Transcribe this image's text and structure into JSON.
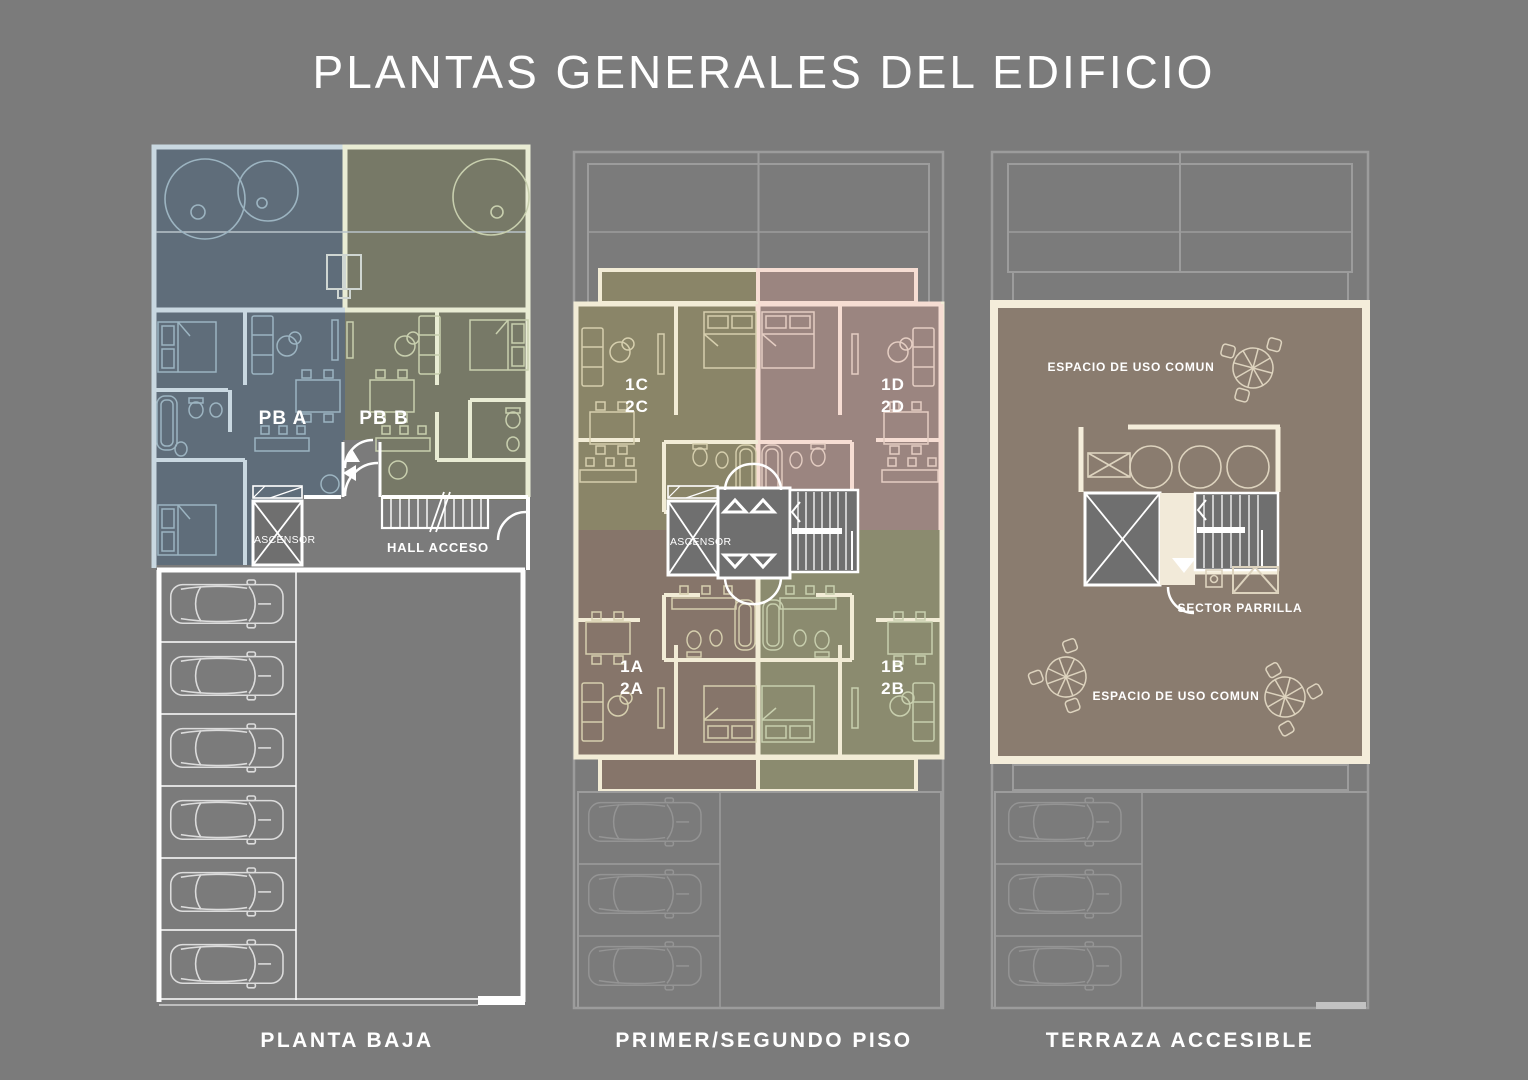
{
  "title": "PLANTAS GENERALES DEL EDIFICIO",
  "colors": {
    "background": "#7b7b7b",
    "line_white": "#ffffff",
    "pba_fill": "#5f6d7a",
    "pba_wall": "#c9d8e1",
    "pbb_fill": "#777967",
    "pbb_wall": "#e9ecd4",
    "u1c_fill": "#8a8568",
    "u1d_fill": "#9b8580",
    "u1a_fill": "#86756a",
    "u1b_fill": "#8b8b6f",
    "wall_cream": "#f2ecd6",
    "wall_pink": "#f6ddd3",
    "terrace_fill": "#8a7c6f",
    "terrace_border": "#f4edda",
    "ghost_line": "#9c9c9c",
    "core_gray": "#6f6f6f"
  },
  "plans": {
    "planta_baja": {
      "caption": "PLANTA BAJA",
      "unit_a_label": "PB A",
      "unit_b_label": "PB B",
      "elevator_label": "ASCENSOR",
      "hall_label": "HALL ACCESO"
    },
    "primer_segundo": {
      "caption": "PRIMER/SEGUNDO PISO",
      "unit_c_line1": "1C",
      "unit_c_line2": "2C",
      "unit_d_line1": "1D",
      "unit_d_line2": "2D",
      "unit_a_line1": "1A",
      "unit_a_line2": "2A",
      "unit_b_line1": "1B",
      "unit_b_line2": "2B",
      "elevator_label": "ASCENSOR"
    },
    "terraza": {
      "caption": "TERRAZA ACCESIBLE",
      "common_space_top": "ESPACIO DE USO COMUN",
      "parrilla_label": "SECTOR PARRILLA",
      "common_space_bottom": "ESPACIO DE USO COMUN"
    }
  }
}
